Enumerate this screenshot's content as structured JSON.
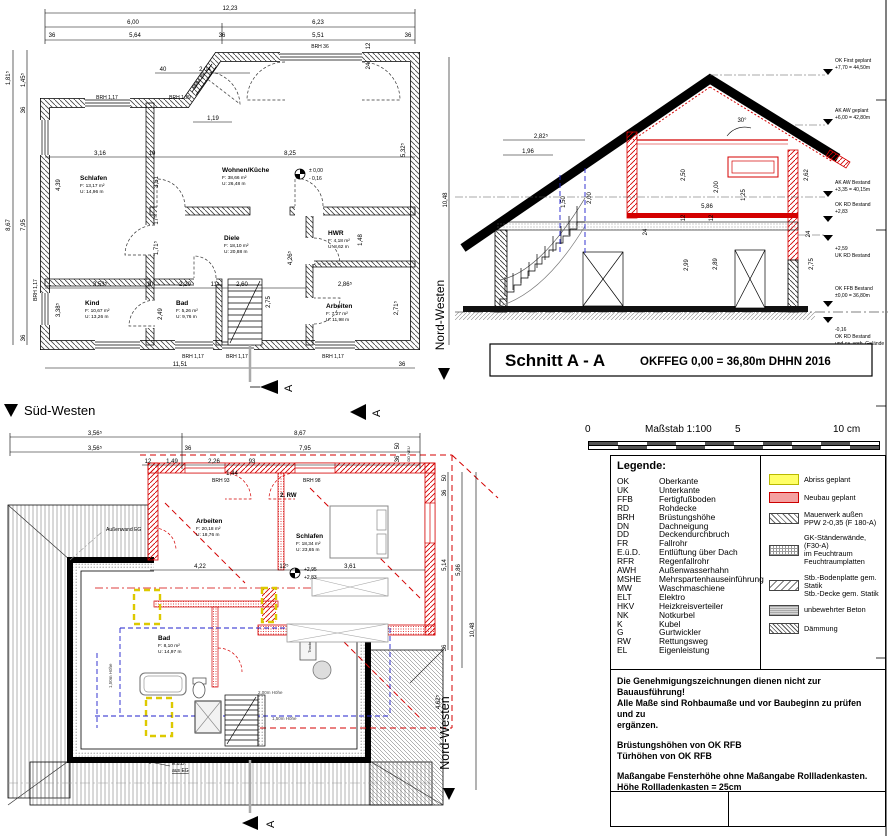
{
  "eg": {
    "compass": "Nord-Westen",
    "sec": "A",
    "lv": {
      "l1": "± 0,00",
      "l2": "- 0,16"
    },
    "d": {
      "t1": "12,23",
      "t2": "6,00",
      "t3": "6,23",
      "t4": "36",
      "t5": "5,64",
      "t6": "36",
      "t7": "5,51",
      "t8": "36",
      "l1": "1,81⁵",
      "l2": "1,45⁵",
      "l3": "36",
      "l4": "8,67",
      "l5": "7,95",
      "l6": "36",
      "r1": "10,48",
      "r2": "5,32⁵",
      "b1": "11,51",
      "b2": "36",
      "i1": "3,16",
      "i2": "10",
      "i3": "8,25",
      "i4": "4,39",
      "i5": "3,51",
      "i6": "3,53⁵",
      "i7": "10",
      "i8": "2,20",
      "i9": "11⁵",
      "i10": "2,60",
      "i11": "2,86⁵",
      "i12": "2,75",
      "i13": "2,71⁵",
      "i14": "1,71⁵",
      "i15": "17⁵",
      "i16": "3,38⁵",
      "i17": "2,49",
      "i18": "1,48",
      "i19": "4,26⁵",
      "e1": "40",
      "e2": "2,04",
      "e3": "1,19",
      "e4": "24",
      "e5": "12"
    },
    "w": {
      "w1": "BRH 1,17",
      "w2": "BRH 1,29",
      "w3": "BRH 36",
      "w4": "BRH 15",
      "w5": "BRH 1,17",
      "w6": "BRH 1,17",
      "w7": "BRH 1,17",
      "w8": "BRH 1,17"
    },
    "rooms": {
      "schlafen": {
        "name": "Schlafen",
        "area": "F:   13,17 m²",
        "per": "U:  14,96 m"
      },
      "wohnen": {
        "name": "Wohnen/Küche",
        "area": "F:   38,66 m²",
        "per": "U:  26,48 m"
      },
      "diele": {
        "name": "Diele",
        "area": "F:  18,10 m²",
        "per": "U: 20,88 m"
      },
      "hwr": {
        "name": "HWR",
        "area": "F:  4,18 m²",
        "per": "U: 8,62 m"
      },
      "kind": {
        "name": "Kind",
        "area": "F:   10,67 m²",
        "per": "U: 13,26 m"
      },
      "bad": {
        "name": "Bad",
        "area": "F:  5,26 m²",
        "per": "U: 9,76 m"
      },
      "arbeiten": {
        "name": "Arbeiten",
        "area": "F:  7,27 m²",
        "per": "U: 11,98 m"
      }
    }
  },
  "section": {
    "title": "Schnitt A - A",
    "subtitle": "OKFFEG  0,00 = 36,80m DHHN 2016",
    "angle": "30°",
    "levels": [
      {
        "a": "OK First geplant",
        "b": "+7,70 = 44,50m"
      },
      {
        "a": "AK AW geplant",
        "b": "+6,00 = 42,80m"
      },
      {
        "a": "AK AW Bestand",
        "b": "+3,35 = 40,15m"
      },
      {
        "a": "OK RD Bestand",
        "b": "+2,83"
      },
      {
        "a": "+2,59",
        "b": "UK RD Bestand"
      },
      {
        "a": "OK FFB Bestand",
        "b": "±0,00 = 36,80m"
      },
      {
        "a": "-0,16",
        "b": "OK RD Bestand",
        "c": "und ca. vorh. Gelände"
      }
    ],
    "d": {
      "s1": "2,82⁵",
      "s2": "1,96",
      "s3": "1,50",
      "s4": "2,00",
      "s5": "2,50",
      "s6": "2,00",
      "s7": "1,25",
      "s8": "5,86",
      "s9": "2,62",
      "s11": "2,99",
      "s12": "2,89",
      "s13": "2,75",
      "s14": "24",
      "s15": "24",
      "s16": "12",
      "s17": "12"
    }
  },
  "dg": {
    "heading": "Süd-Westen",
    "compass": "Nord-Westen",
    "sec": "A",
    "lv": {
      "l1": "+2,95",
      "l2": "+2,83"
    },
    "labels": {
      "rw": "2. RW",
      "aw": "Außenwand EG",
      "brh93": "BRH 93",
      "brh98": "BRH 98",
      "h200": "2,00m Höhe",
      "h150": "1,50m Höhe",
      "h150b": "1,50m Höhe",
      "eued": "E.ü.D.",
      "eued2": "aus EG",
      "ddneu": "DD NEU",
      "trockner": "Trockner"
    },
    "d": {
      "t1": "3,56⁵",
      "t2": "8,67",
      "t3": "3,56⁵",
      "t4": "36",
      "t5": "7,95",
      "t6": "12",
      "t7": "1,49",
      "t8": "2,26",
      "t9": "93",
      "t10": "1,44",
      "m1": "4,22",
      "m2": "12⁵",
      "m3": "3,61",
      "r0": "50",
      "r1": "36",
      "r2": "5,14",
      "r3": "5,86",
      "r4": "10,48",
      "r5": "36",
      "r6": "4,62⁵",
      "c1": "50",
      "c2": "36"
    },
    "rooms": {
      "arbeiten": {
        "name": "Arbeiten",
        "area": "F:   20,18 m²",
        "per": "U: 18,76 m"
      },
      "schlafen": {
        "name": "Schlafen",
        "area": "F:   18,34 m²",
        "per": "U: 23,65 m"
      },
      "bad": {
        "name": "Bad",
        "area": "F:   8,10 m²",
        "per": "U: 14,97 m"
      }
    }
  },
  "scalebar": {
    "zero": "0",
    "label": "Maßstab 1:100",
    "five": "5",
    "ten": "10 cm"
  },
  "legend": {
    "title": "Legende:",
    "items": [
      {
        "abbr": "OK",
        "term": "Oberkante"
      },
      {
        "abbr": "UK",
        "term": "Unterkante"
      },
      {
        "abbr": "FFB",
        "term": "Fertigfußboden"
      },
      {
        "abbr": "RD",
        "term": "Rohdecke"
      },
      {
        "abbr": "BRH",
        "term": "Brüstungshöhe"
      },
      {
        "abbr": "DN",
        "term": "Dachneigung"
      },
      {
        "abbr": "DD",
        "term": "Deckendurchbruch"
      },
      {
        "abbr": "FR",
        "term": "Fallrohr"
      },
      {
        "abbr": "E.ü.D.",
        "term": "Entlüftung über Dach"
      },
      {
        "abbr": "RFR",
        "term": "Regenfallrohr"
      },
      {
        "abbr": "AWH",
        "term": "Außenwasserhahn"
      },
      {
        "abbr": "MSHE",
        "term": "Mehrspartenhauseinführung"
      },
      {
        "abbr": "MW",
        "term": "Waschmaschiene"
      },
      {
        "abbr": "ELT",
        "term": "Elektro"
      },
      {
        "abbr": "HKV",
        "term": "Heizkreisverteiler"
      },
      {
        "abbr": "NK",
        "term": "Notkurbel"
      },
      {
        "abbr": "K",
        "term": "Kubel"
      },
      {
        "abbr": "G",
        "term": "Gurtwickler"
      },
      {
        "abbr": "RW",
        "term": "Rettungsweg"
      },
      {
        "abbr": "EL",
        "term": "Eigenleistung"
      }
    ],
    "symbols": [
      {
        "l1": "Abriss geplant",
        "l2": ""
      },
      {
        "l1": "Neubau geplant",
        "l2": ""
      },
      {
        "l1": "Mauerwerk außen",
        "l2": "PPW 2-0,35 (F 180-A)"
      },
      {
        "l1": "GK-Ständerwände, (F30-A)",
        "l2": "im Feuchtraum Feuchtraumplatten"
      },
      {
        "l1": "Stb.-Bodenplatte gem. Statik",
        "l2": "Stb.-Decke gem. Statik"
      },
      {
        "l1": "unbewehrter Beton",
        "l2": ""
      },
      {
        "l1": "Dämmung",
        "l2": ""
      }
    ]
  },
  "notes": {
    "n1": "Die Genehmigungszeichnungen dienen nicht zur Bauausführung!",
    "n2": "Alle Maße sind Rohbaumaße und vor Baubeginn zu prüfen und zu",
    "n3": "ergänzen.",
    "n4": "Brüstungshöhen von OK RFB",
    "n5": "Türhöhen von OK RFB",
    "n6": "Maßangabe Fensterhöhe ohne Maßangabe Rollladenkasten.",
    "n7": "Höhe Rollladenkasten = 25cm"
  }
}
